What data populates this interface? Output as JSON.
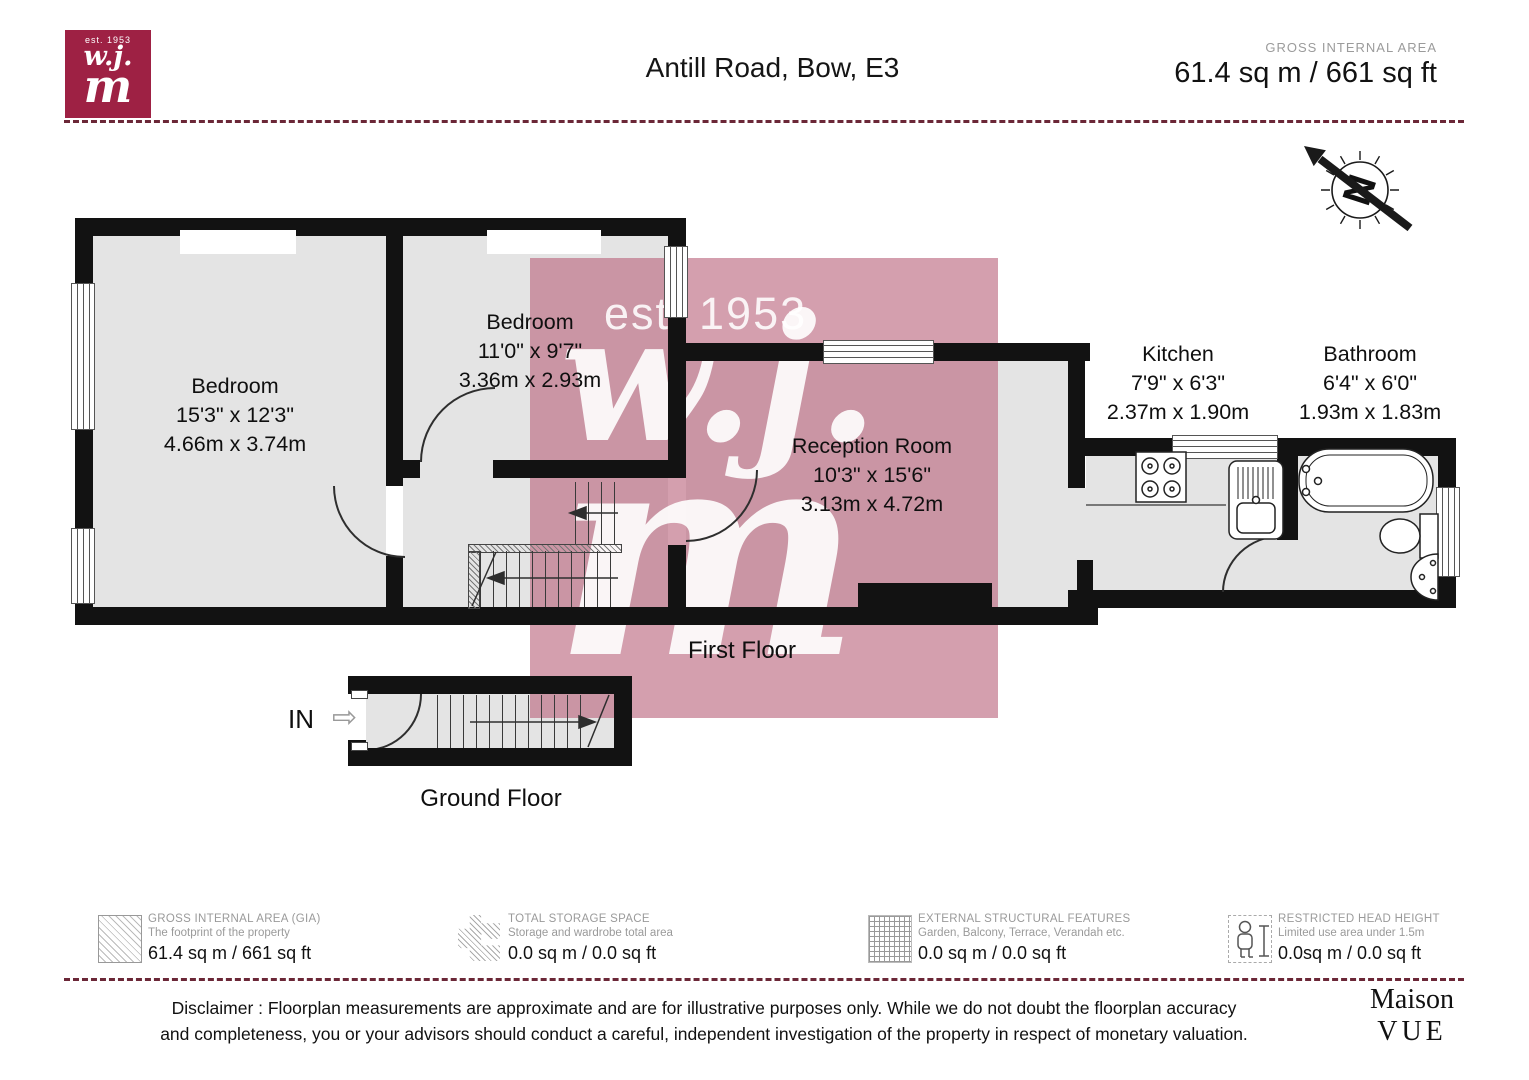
{
  "header": {
    "logo_est": "est. 1953",
    "logo_line1": "w.j.",
    "logo_line2": "m",
    "title": "Antill Road, Bow, E3",
    "gia_label": "GROSS INTERNAL AREA",
    "gia_value": "61.4 sq m / 661 sq ft"
  },
  "compass": {
    "letter": "N"
  },
  "watermark": {
    "est": "est. 1953",
    "line1": "w.j.",
    "line2": "m"
  },
  "rooms": [
    {
      "name": "Bedroom",
      "imperial": "15'3\" x 12'3\"",
      "metric": "4.66m x 3.74m"
    },
    {
      "name": "Bedroom",
      "imperial": "11'0\" x 9'7\"",
      "metric": "3.36m x 2.93m"
    },
    {
      "name": "Reception Room",
      "imperial": "10'3\" x 15'6\"",
      "metric": "3.13m x 4.72m"
    },
    {
      "name": "Kitchen",
      "imperial": "7'9\" x 6'3\"",
      "metric": "2.37m x 1.90m"
    },
    {
      "name": "Bathroom",
      "imperial": "6'4\" x 6'0\"",
      "metric": "1.93m x 1.83m"
    }
  ],
  "floors": {
    "first_label": "First Floor",
    "ground_label": "Ground Floor",
    "entrance_label": "IN"
  },
  "legend": [
    {
      "title": "GROSS INTERNAL AREA (GIA)",
      "subtitle": "The footprint of the property",
      "value": "61.4 sq m / 661 sq ft",
      "icon": "diagonal-hatch"
    },
    {
      "title": "TOTAL STORAGE SPACE",
      "subtitle": "Storage and wardrobe total area",
      "value": "0.0 sq m / 0.0 sq ft",
      "icon": "storage-hatch"
    },
    {
      "title": "EXTERNAL STRUCTURAL FEATURES",
      "subtitle": "Garden, Balcony, Terrace, Verandah etc.",
      "value": "0.0 sq m / 0.0 sq ft",
      "icon": "grid-hatch"
    },
    {
      "title": "RESTRICTED HEAD HEIGHT",
      "subtitle": "Limited use area under 1.5m",
      "value": "0.0sq m / 0.0 sq ft",
      "icon": "person-height"
    }
  ],
  "footer": {
    "disclaimer_line1": "Disclaimer : Floorplan measurements are approximate and are for illustrative purposes only. While we do not doubt the floorplan accuracy",
    "disclaimer_line2": "and completeness, you or your advisors should conduct a careful, independent investigation of the property in respect of monetary valuation.",
    "brand_line1": "Maison",
    "brand_line2": "VUE"
  },
  "colors": {
    "wall": "#121212",
    "floor": "#e4e4e4",
    "watermark_pink": "#ba647d",
    "logo_red": "#9e2144",
    "dashed_line": "#6b2737"
  }
}
